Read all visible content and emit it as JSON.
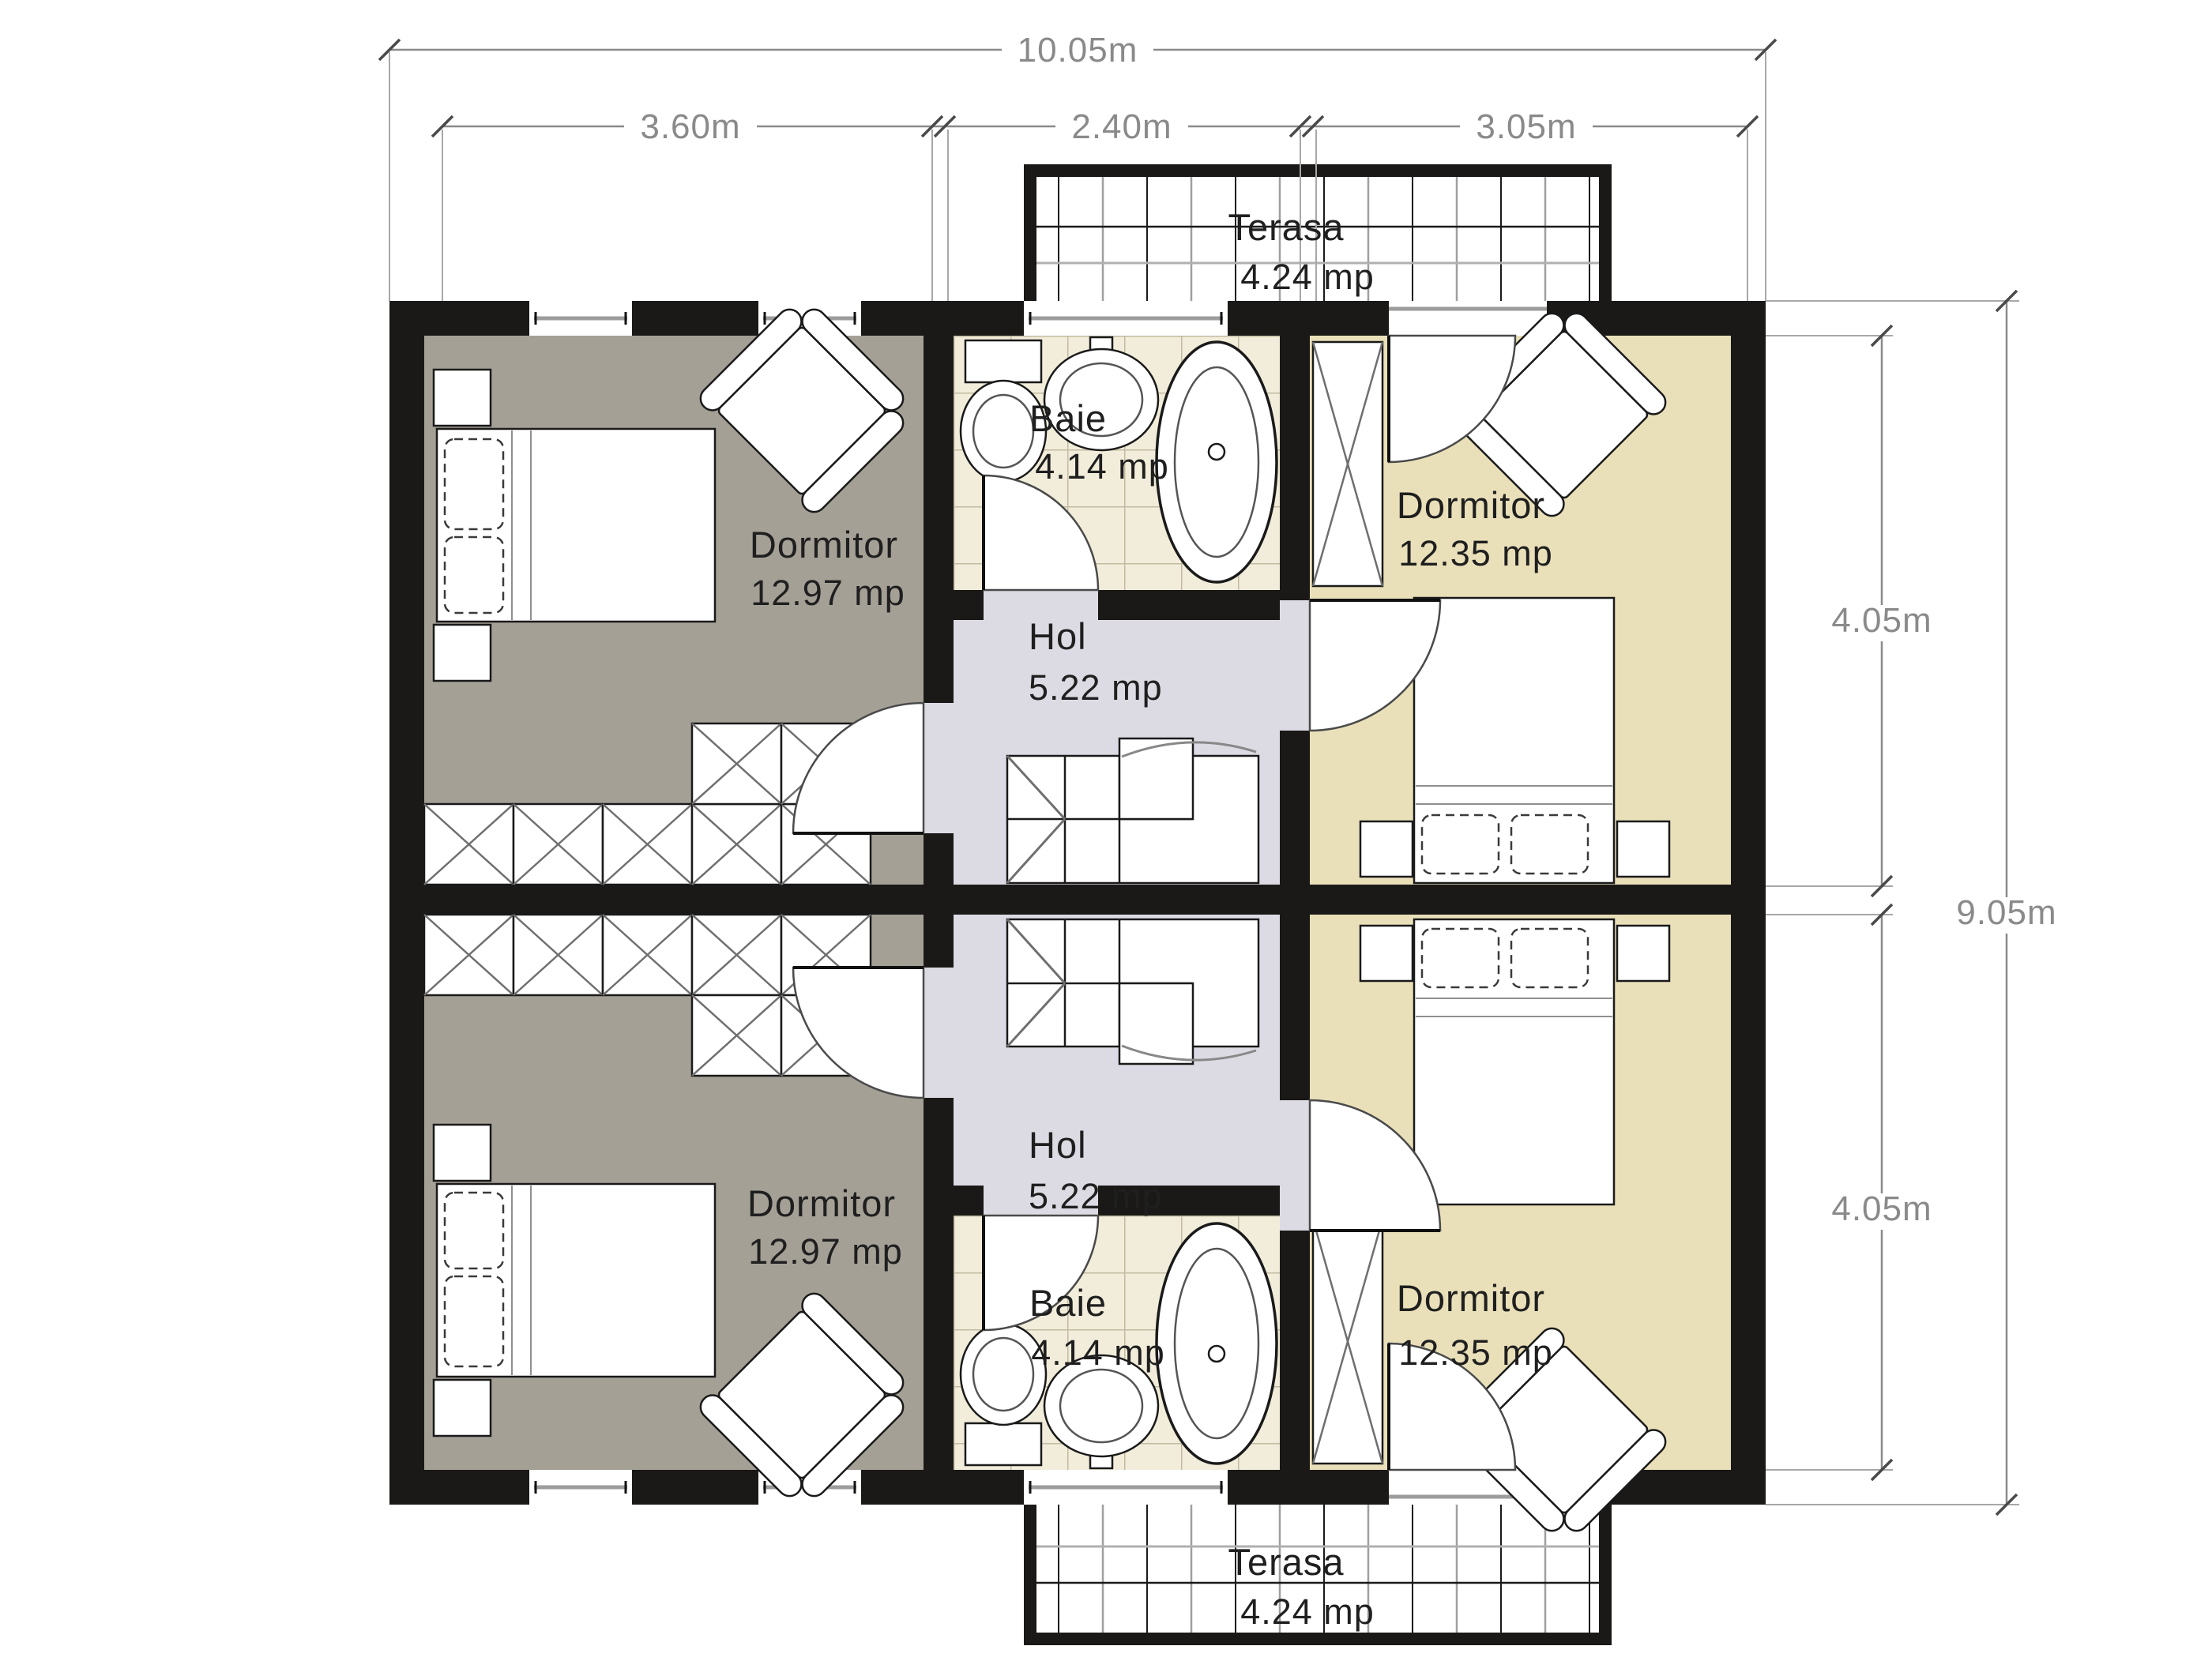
{
  "colors": {
    "wall": "#1b1917",
    "bedroom_left_floor": "#a5a096",
    "bedroom_right_floor": "#e9e0ba",
    "bath_floor": "#f1edda",
    "hall_floor": "#dcdbe3",
    "tile_line": "#c3baa1",
    "dim_line": "#8a8a8a",
    "label_text": "#1f1f1f"
  },
  "rooms": {
    "bedroom_top_left": {
      "name": "Dormitor",
      "area": "12.97 mp"
    },
    "bedroom_bottom_left": {
      "name": "Dormitor",
      "area": "12.97 mp"
    },
    "bedroom_top_right": {
      "name": "Dormitor",
      "area": "12.35 mp"
    },
    "bedroom_bottom_right": {
      "name": "Dormitor",
      "area": "12.35 mp"
    },
    "bath_top": {
      "name": "Baie",
      "area": "4.14 mp"
    },
    "bath_bottom": {
      "name": "Baie",
      "area": "4.14 mp"
    },
    "hall_top": {
      "name": "Hol",
      "area": "5.22 mp"
    },
    "hall_bottom": {
      "name": "Hol",
      "area": "5.22 mp"
    },
    "terrace_top": {
      "name": "Terasa",
      "area": "4.24 mp"
    },
    "terrace_bottom": {
      "name": "Terasa",
      "area": "4.24 mp"
    }
  },
  "dimensions": {
    "total_width": "10.05m",
    "left_span": "3.60m",
    "center_span": "2.40m",
    "right_span": "3.05m",
    "total_height": "9.05m",
    "upper_span": "4.05m",
    "lower_span": "4.05m"
  }
}
